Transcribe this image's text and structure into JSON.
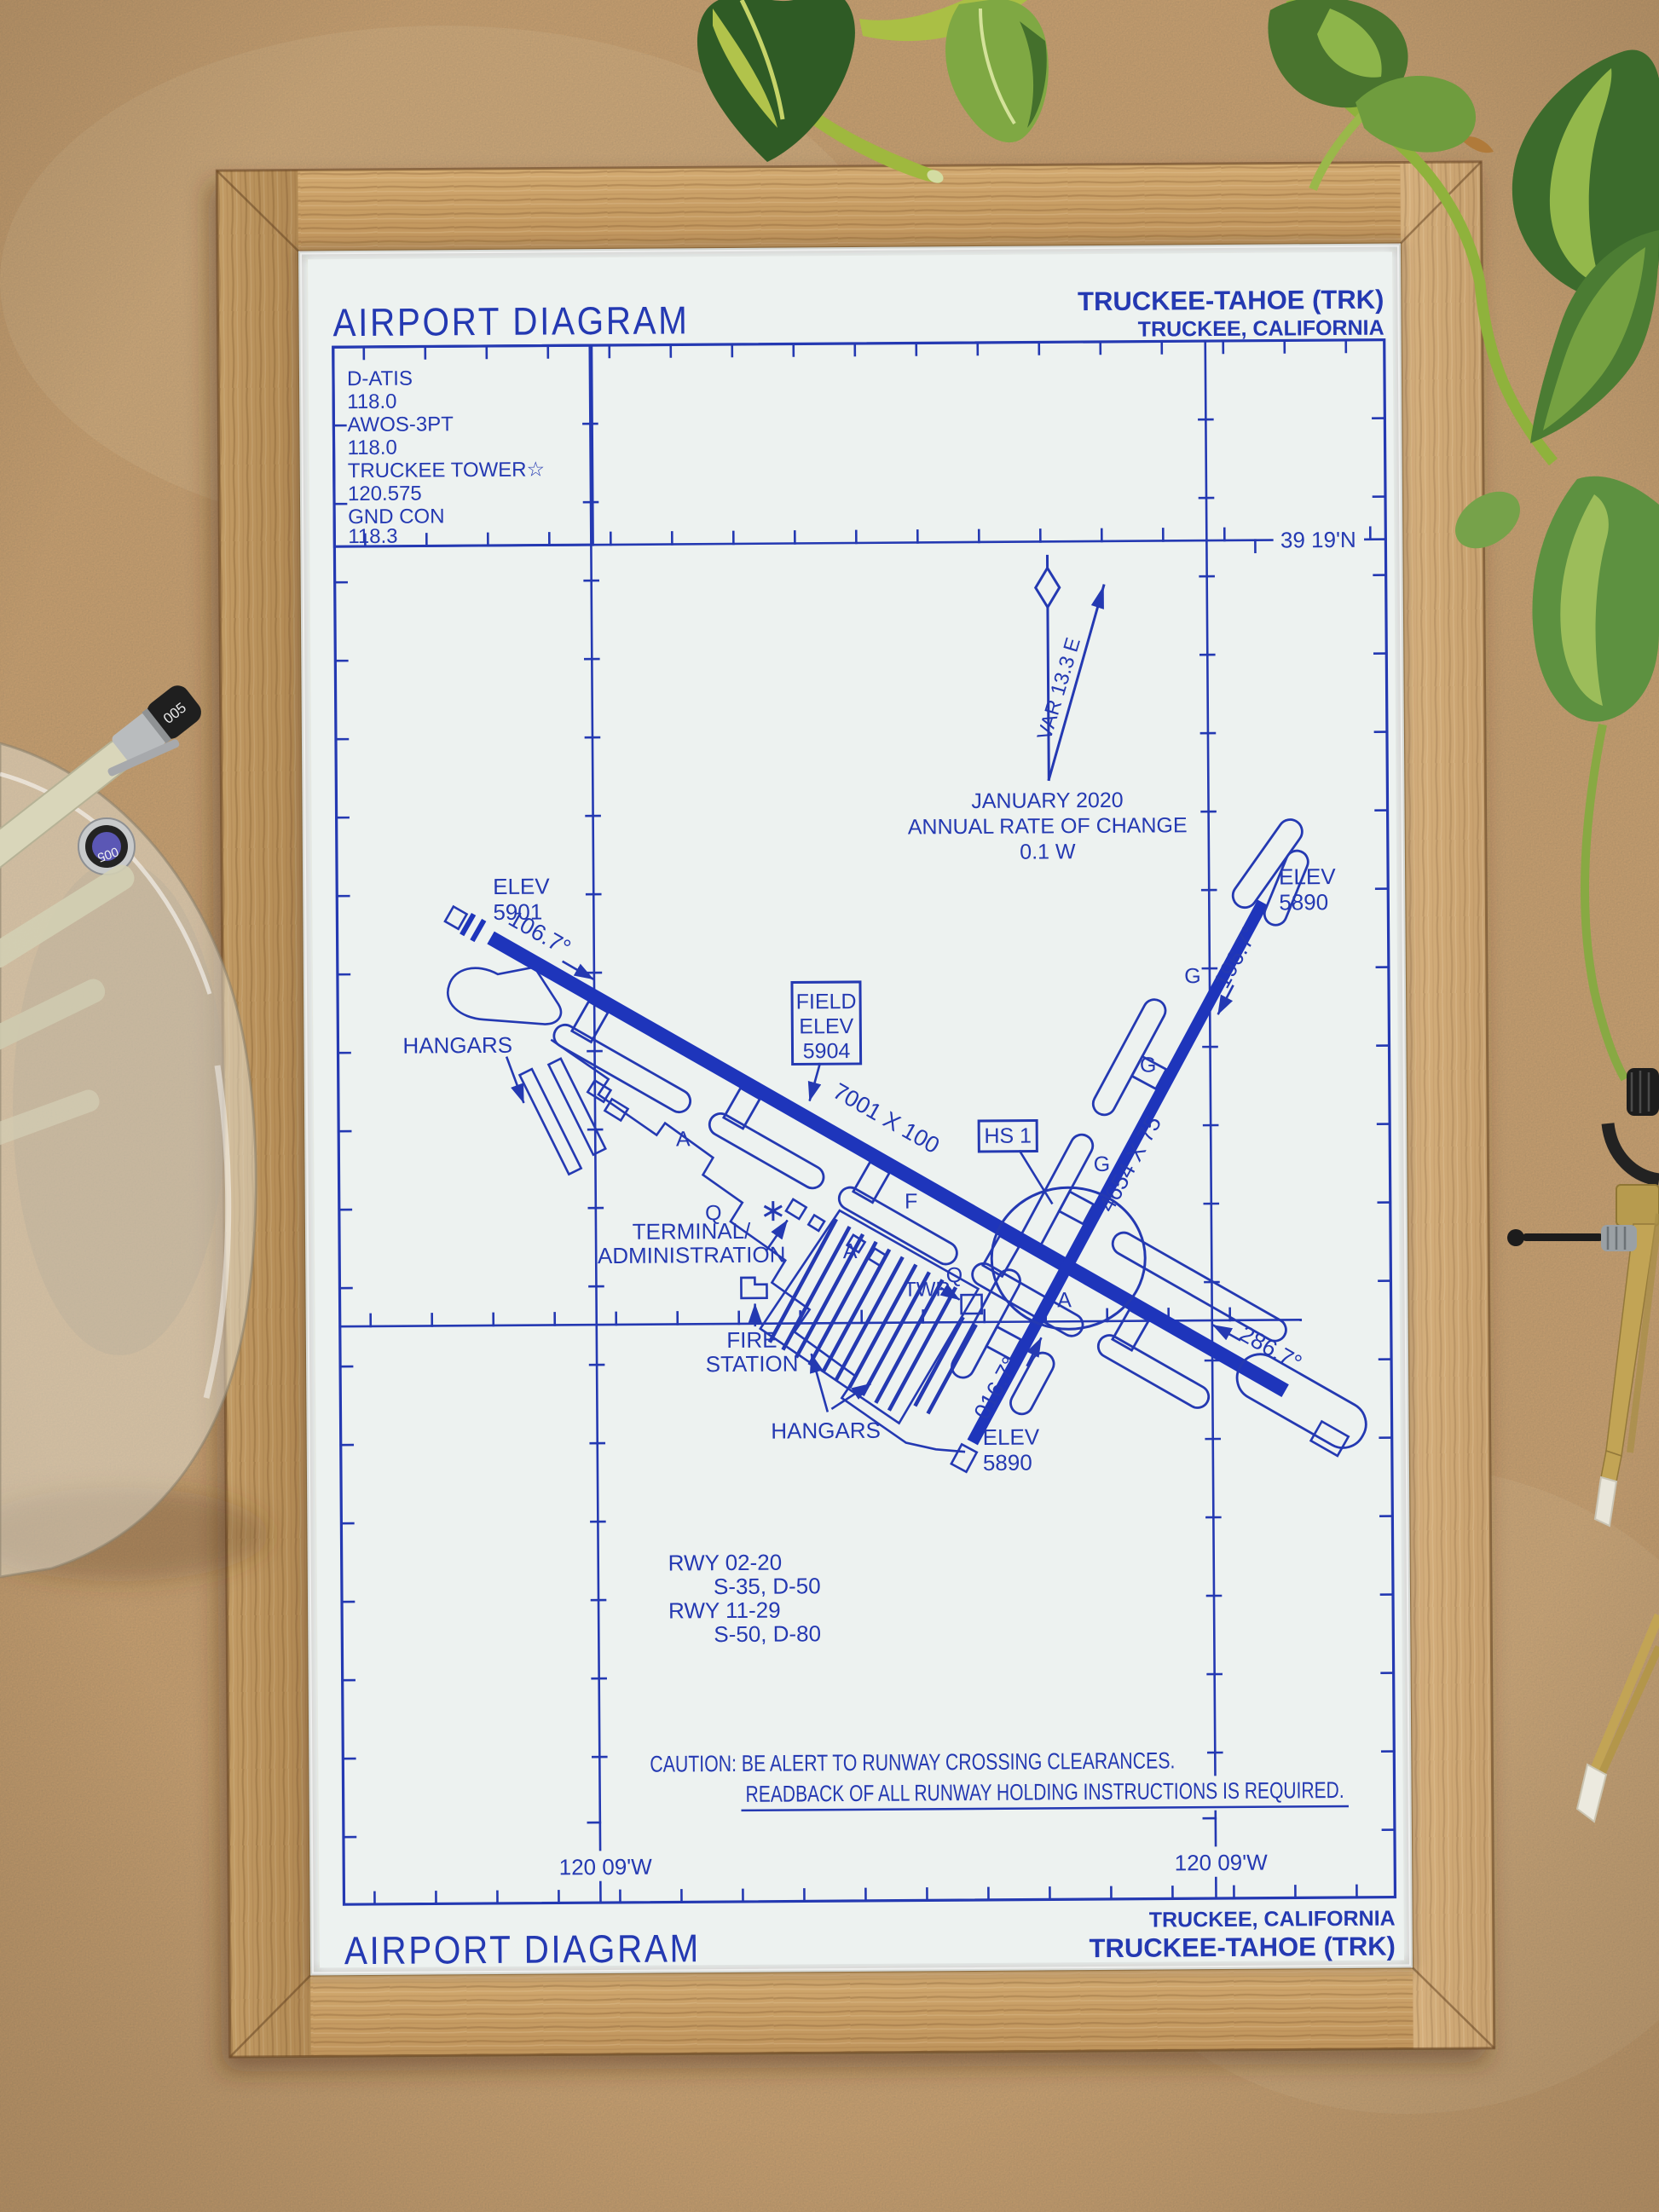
{
  "header": {
    "title": "AIRPORT DIAGRAM",
    "airport": "TRUCKEE-TAHOE (TRK)",
    "city": "TRUCKEE, CALIFORNIA"
  },
  "footer": {
    "title": "AIRPORT DIAGRAM",
    "airport": "TRUCKEE-TAHOE (TRK)",
    "city": "TRUCKEE, CALIFORNIA"
  },
  "comm": {
    "lines": [
      "D-ATIS",
      "118.0",
      "AWOS-3PT",
      "118.0",
      "TRUCKEE TOWER☆",
      "120.575",
      "GND CON",
      "118.3"
    ]
  },
  "coords": {
    "lat": "39 19'N",
    "lon_left": "120 09'W",
    "lon_right": "120 09'W"
  },
  "compass": {
    "variation": "VAR 13.3 E",
    "date": "JANUARY 2020",
    "rate_label": "ANNUAL RATE OF CHANGE",
    "rate_value": "0.1  W"
  },
  "field_elev": {
    "line1": "FIELD",
    "line2": "ELEV",
    "line3": "5904"
  },
  "hotspot": {
    "label": "HS 1"
  },
  "runways": {
    "r1129": {
      "dim": "7001 X 100",
      "hdg_se": "106.7°",
      "hdg_nw": "286.7°",
      "elev_w_label": "ELEV",
      "elev_w_value": "5901"
    },
    "r0220": {
      "dim": "4654 X 75",
      "hdg_ne": "016.7°",
      "hdg_sw": "196.7°",
      "elev_n_label": "ELEV",
      "elev_n_value": "5890",
      "elev_s_label": "ELEV",
      "elev_s_value": "5890"
    }
  },
  "labels": {
    "hangars_nw": "HANGARS",
    "hangars_s": "HANGARS",
    "terminal_line1": "TERMINAL/",
    "terminal_line2": "ADMINISTRATION",
    "fire_line1": "FIRE",
    "fire_line2": "STATION",
    "twr": "TWR"
  },
  "taxiway_letters": {
    "a1": "A",
    "q1": "Q",
    "a2": "A",
    "f1": "F",
    "q2": "Q",
    "a3": "A",
    "g1": "G",
    "g2": "G",
    "g3": "G"
  },
  "runway_data": {
    "l1": "RWY 02-20",
    "l2": "S-35, D-50",
    "l3": "RWY 11-29",
    "l4": "S-50, D-80"
  },
  "caution": {
    "line1": "CAUTION: BE ALERT TO RUNWAY CROSSING CLEARANCES.",
    "line2": "READBACK OF ALL RUNWAY HOLDING INSTRUCTIONS IS REQUIRED."
  },
  "props": {
    "pen_cap_top": "005",
    "pen_cap_side": "005"
  },
  "colors": {
    "ink": "#2439b2",
    "runway_fill": "#1e35bb",
    "paper": "#eef2f0",
    "frame_wood": "#c9a265",
    "cardboard": "#c29b6d",
    "leaf_dark": "#3c6b2c",
    "leaf_light": "#9cc14f",
    "brass": "#c2a455"
  }
}
